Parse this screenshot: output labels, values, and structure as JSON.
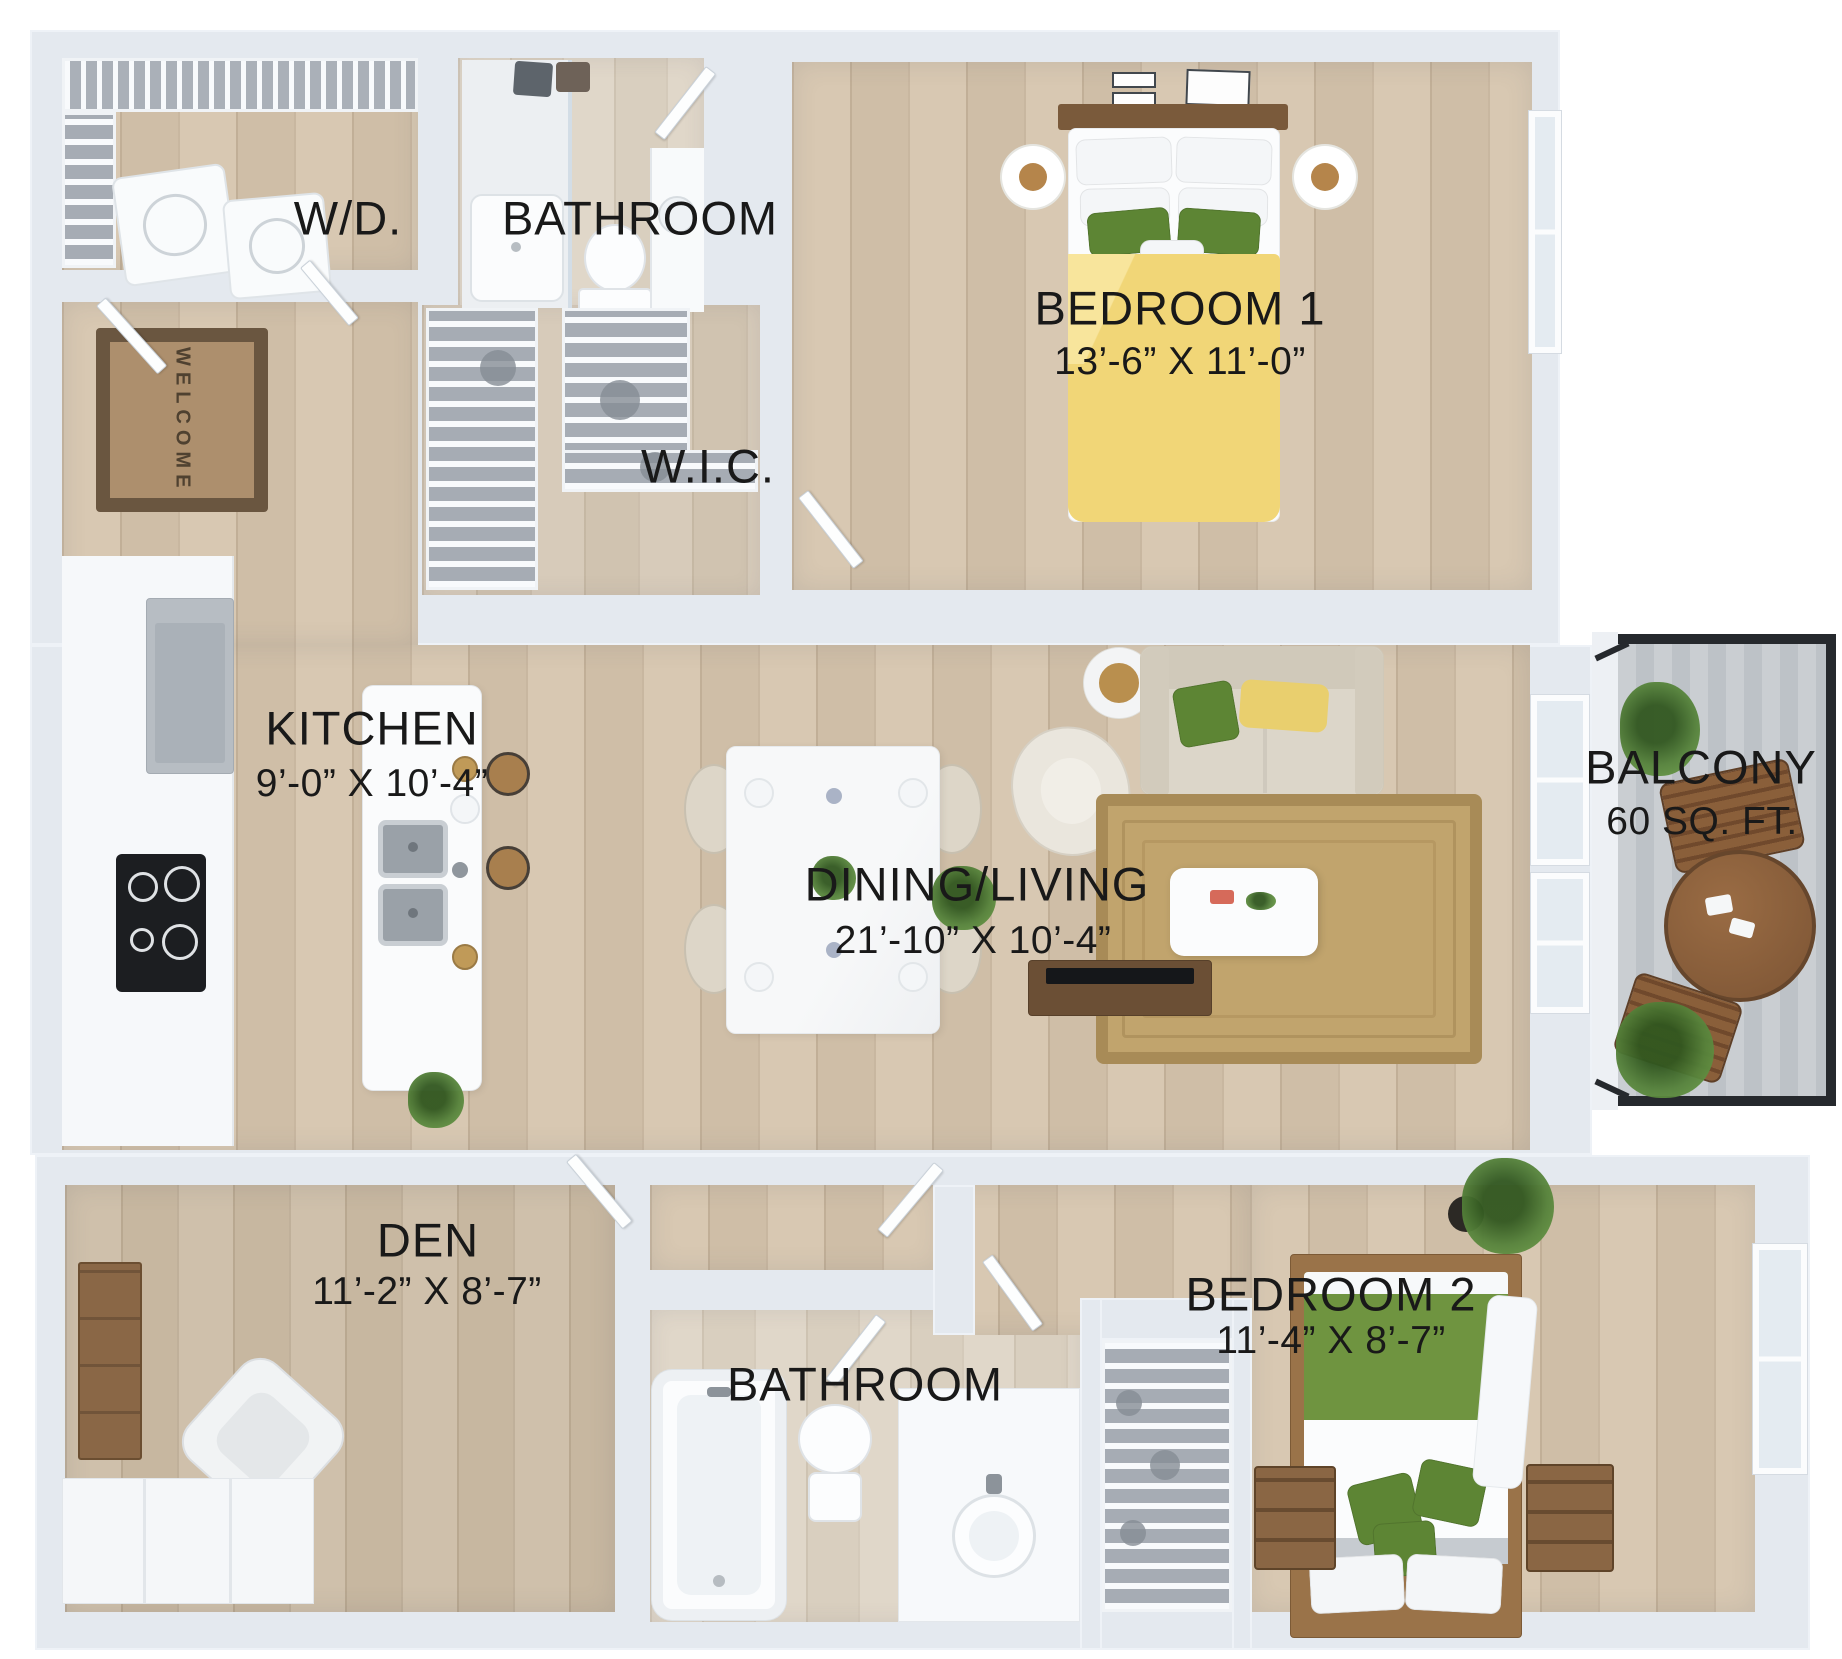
{
  "floorplan": {
    "rooms": {
      "wd": {
        "label": "W/D."
      },
      "bathroom_top": {
        "label": "BATHROOM"
      },
      "bedroom_1": {
        "label": "BEDROOM 1",
        "dims": "13’-6” X 11’-0”"
      },
      "wic": {
        "label": "W.I.C."
      },
      "kitchen": {
        "label": "KITCHEN",
        "dims": "9’-0” X 10’-4”"
      },
      "dining_living": {
        "label": "DINING/LIVING",
        "dims": "21’-10” X 10’-4”"
      },
      "balcony": {
        "label": "BALCONY",
        "dims": "60 SQ. FT."
      },
      "den": {
        "label": "DEN",
        "dims": "11’-2” X 8’-7”"
      },
      "bathroom_bottom": {
        "label": "BATHROOM"
      },
      "bedroom_2": {
        "label": "BEDROOM 2",
        "dims": "11’-4” X 8’-7”"
      }
    },
    "welcome_mat_text": "WELCOME",
    "colors": {
      "wall": "#e4e9ef",
      "floor_wood": "#d5c5af",
      "bed1_duvet_yellow": "#f1d677",
      "bed2_blanket_green": "#6f9440",
      "accent_pillow_green": "#5d8534",
      "sofa_cream": "#dcd6c9",
      "rug_jute": "#c1a46d",
      "balcony_frame": "#26292d",
      "label_text": "#191919"
    }
  }
}
